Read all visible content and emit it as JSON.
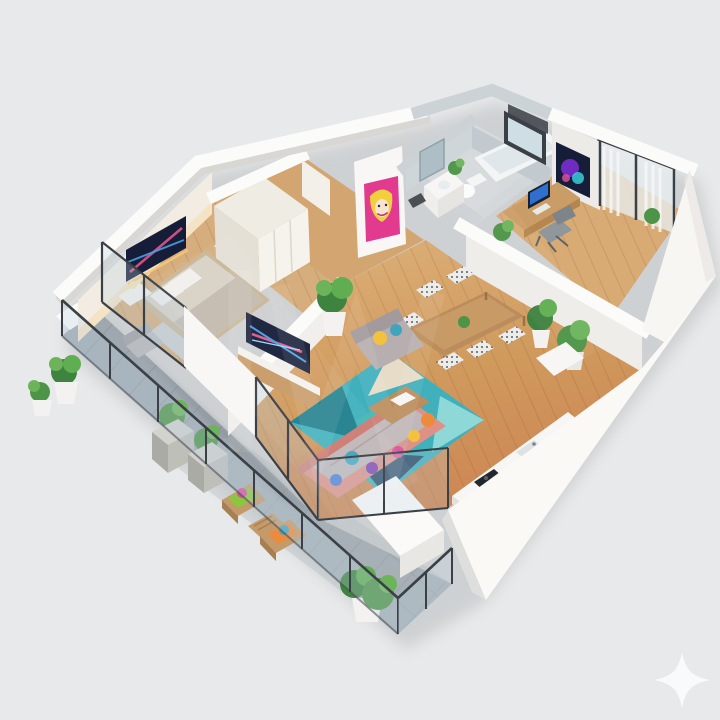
{
  "scene": {
    "type": "3d-isometric-floor-plan-render",
    "description": "Isometric 3D cutaway floor plan of a two-room apartment with wraparound tiled balcony",
    "rooms": [
      {
        "name": "bedroom",
        "items": [
          "double-bed",
          "wardrobe",
          "nightstands-with-lamps",
          "wall-mounted-tv-art",
          "accent-chair",
          "gray-rug",
          "balcony-glass-door"
        ]
      },
      {
        "name": "living-room",
        "items": [
          "corner-sofa-salmon-gray",
          "armchair",
          "colorful-pillows",
          "teal-geometric-rug",
          "coffee-table",
          "tv-console",
          "potted-plant"
        ]
      },
      {
        "name": "dining-area",
        "items": [
          "wooden-dining-table",
          "six-patterned-chairs",
          "potted-plants"
        ]
      },
      {
        "name": "kitchenette",
        "items": [
          "counter-run",
          "sink",
          "black-cooktop"
        ]
      },
      {
        "name": "bathroom",
        "items": [
          "bathtub",
          "toilet",
          "vanity-sink",
          "mirror",
          "plant",
          "window"
        ]
      },
      {
        "name": "office",
        "items": [
          "desk",
          "monitor",
          "office-chair",
          "abstract-wall-art",
          "sheer-curtains",
          "glass-door",
          "plants"
        ]
      },
      {
        "name": "balcony",
        "items": [
          "glass-railing",
          "two-lounge-chairs",
          "side-table",
          "square-planters",
          "round-planters",
          "bushes"
        ]
      }
    ],
    "wall_art": [
      "pop-art-portrait-pink",
      "abstract-neon-panel-bedroom",
      "abstract-neon-tv-living",
      "abstract-purple-canvas-office"
    ],
    "overlays": {
      "watermark": "large translucent logo letters (illegible)",
      "sparkle_icon": "four-point star, bottom-right corner"
    }
  },
  "palette": {
    "background": "#e8e9ea",
    "shadow": "#9aa0a4",
    "wall_white": "#fbfbf9",
    "wall_shade": "#d9d7d3",
    "concrete": "#c6cdd1",
    "bedroom_wood": "#d6ad7c",
    "office_wood": "#d8ab74",
    "tile": "#9fa8b0",
    "bath_floor": "#d6dadd",
    "glass": "#bcd2de",
    "frame_dark": "#3b4046",
    "rug_teal": "#3fb0bc",
    "rug_navy": "#2a4a66",
    "rug_beige": "#e7dcc8",
    "sofa_salmon": "#e09186",
    "sofa_gray": "#b7aeb0",
    "bed_duvet": "#d8d1c6",
    "pillow_yellow": "#f2c23e",
    "pillow_orange": "#ee8a3c",
    "pillow_teal": "#3fa4bc",
    "pillow_purple": "#7d3fae",
    "pillow_magenta": "#d84f9b",
    "pillow_green": "#8cc63f",
    "art_navy": "#161d38",
    "art_pink": "#e23a8e",
    "art_yellow": "#f0d03c",
    "plant_green": "#4e9447",
    "pot_white": "#f3f2f0",
    "pot_concrete": "#c6c6c2",
    "table_wood": "#bb8d5c",
    "counter_white": "#f6f6f4",
    "cooktop": "#23282e",
    "screen_blue": "#2f6fd0",
    "watermark_color": "#ffffff",
    "sparkle": "#fafbfc"
  }
}
